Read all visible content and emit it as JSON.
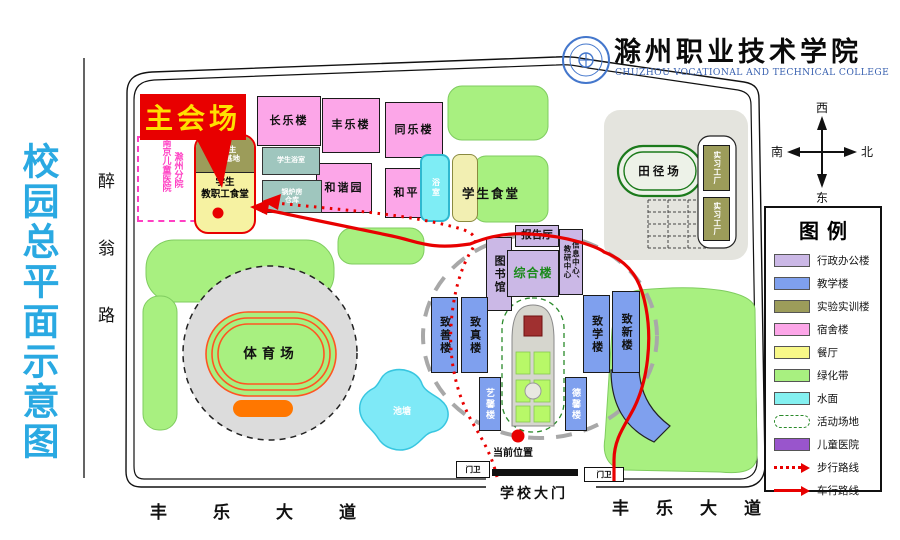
{
  "header": {
    "map_title": "校园总平面示意图",
    "college_name": "滁州职业技术学院",
    "college_name_en": "CHUZHOU VOCATIONAL AND TECHNICAL COLLEGE",
    "main_venue_callout": "主会场"
  },
  "compass": {
    "top": "西",
    "bottom": "东",
    "left": "南",
    "right": "北"
  },
  "roads": {
    "west_road": "醉翁路",
    "south_road_left": "丰乐大道",
    "south_road_right": "丰乐大道"
  },
  "gate": {
    "label": "学校大门",
    "guard_left": "门卫",
    "guard_right": "门卫",
    "current_location_label": "当前位置"
  },
  "buildings": {
    "changle": {
      "label": "长乐楼"
    },
    "fengle": {
      "label": "丰乐楼"
    },
    "tongle": {
      "label": "同乐楼"
    },
    "hexie": {
      "label": "和谐园"
    },
    "heping": {
      "label": "和平园"
    },
    "bathhouse": {
      "label": "学生浴室"
    },
    "boiler": {
      "line1": "锅炉房",
      "line2": "仓库"
    },
    "shower": {
      "label": "浴室"
    },
    "student_canteen": {
      "label": "学生食堂"
    },
    "incubator": {
      "line1": "大学生",
      "line2": "孵化基地"
    },
    "staff_canteen": {
      "line1": "学生",
      "line2": "教职工食堂"
    },
    "children_hospital": {
      "col1": "南京儿童医院",
      "col2": "滁州分院"
    },
    "library": {
      "label": "图书馆"
    },
    "lecture_hall": {
      "label": "报告厅"
    },
    "complex": {
      "label": "综合楼"
    },
    "info_center": {
      "label": "信息中心、教研中心"
    },
    "zhishan": {
      "label": "致善楼"
    },
    "zhizhen": {
      "label": "致真楼"
    },
    "zhixue": {
      "label": "致学楼"
    },
    "zhixin": {
      "label": "致新楼"
    },
    "yixin": {
      "label": "艺馨楼"
    },
    "dexin": {
      "label": "德馨楼"
    },
    "workshop_a": {
      "label": "实习工厂"
    },
    "workshop_b": {
      "label": "实习工厂"
    },
    "track_field": {
      "label": "田径场"
    },
    "stadium": {
      "label": "体育场"
    },
    "pond": {
      "label": "池塘"
    }
  },
  "legend": {
    "title": "图例",
    "items": [
      {
        "label": "行政办公楼",
        "type": "swatch",
        "color": "#CBB8E6"
      },
      {
        "label": "教学楼",
        "type": "swatch",
        "color": "#7FA0EE"
      },
      {
        "label": "实验实训楼",
        "type": "swatch",
        "color": "#9C9C5A"
      },
      {
        "label": "宿舍楼",
        "type": "swatch",
        "color": "#FCA6E8"
      },
      {
        "label": "餐厅",
        "type": "swatch",
        "color": "#F8F888"
      },
      {
        "label": "绿化带",
        "type": "swatch",
        "color": "#A8F080"
      },
      {
        "label": "水面",
        "type": "swatch",
        "color": "#84F0F0"
      },
      {
        "label": "活动场地",
        "type": "dashed-outline",
        "color": "#2A8A2A"
      },
      {
        "label": "儿童医院",
        "type": "swatch",
        "color": "#9955CC"
      },
      {
        "label": "步行路线",
        "type": "dotted-arrow",
        "color": "#E80000"
      },
      {
        "label": "车行路线",
        "type": "solid-arrow",
        "color": "#E80000"
      }
    ]
  },
  "colors": {
    "route_red": "#E80000",
    "title_blue": "#2AA9E2",
    "callout_bg": "#E80000",
    "callout_text": "#FFE000",
    "hospital_pink": "#FF3FC3"
  }
}
